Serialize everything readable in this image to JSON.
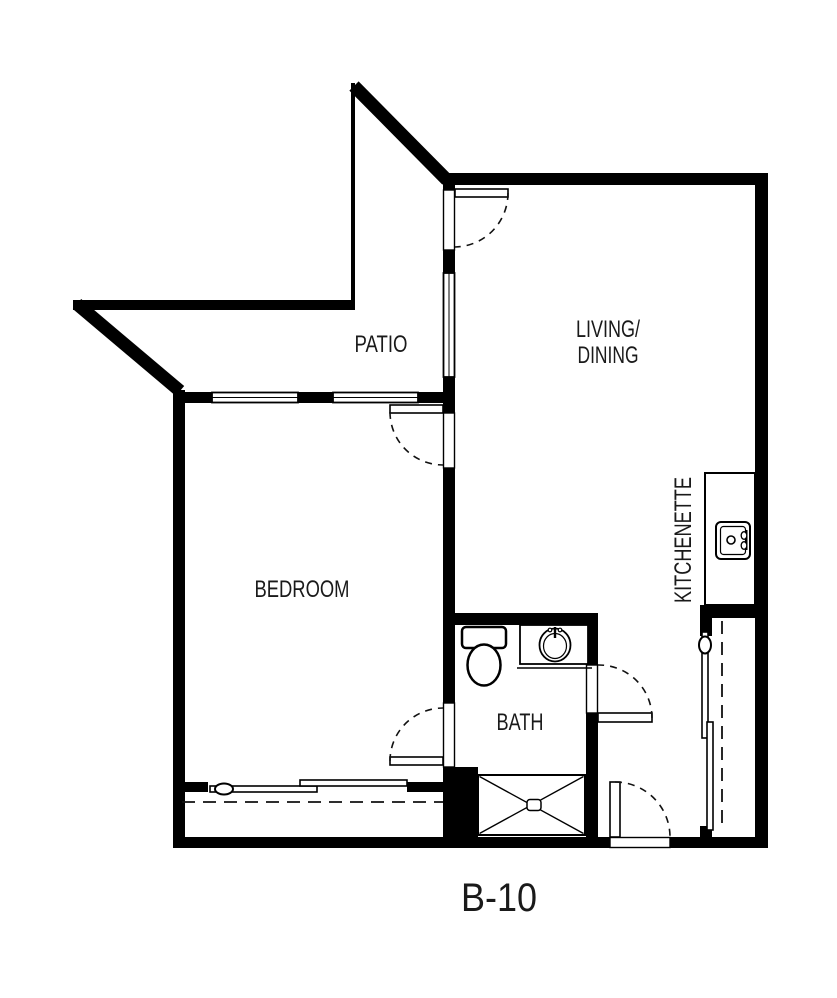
{
  "floorplan": {
    "unit_label": "B-10",
    "rooms": {
      "patio": "PATIO",
      "living_line1": "LIVING/",
      "living_line2": "DINING",
      "bedroom": "BEDROOM",
      "kitchenette": "KITCHENETTE",
      "bath": "BATH"
    }
  },
  "colors": {
    "wall": "#000000",
    "background": "#ffffff",
    "text": "#1a1a1a"
  },
  "icons": [
    "toilet-icon",
    "bathroom-sink-icon",
    "kitchen-sink-icon",
    "shower-pan-icon",
    "door-swing-icon",
    "sliding-closet-door-icon",
    "closet-rod-icon",
    "window-icon"
  ]
}
